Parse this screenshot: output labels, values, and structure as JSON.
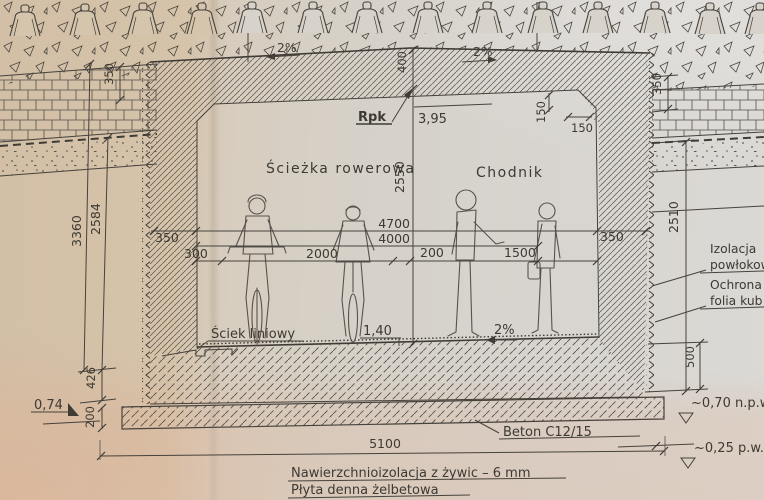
{
  "drawing": {
    "areas": {
      "bike_path": "Ścieżka rowerowa",
      "sidewalk": "Chodnik"
    },
    "annotations": {
      "benchmark": "Rpk",
      "benchmark_level": "3,95",
      "linear_drain": "Ściek liniowy",
      "drain_level": "1,40",
      "floor_slope": "2%",
      "ballast_slope_left": "2%",
      "ballast_slope_right": "2%",
      "foundation_concrete": "Beton C12/15",
      "surface_insulation": "Nawierzchnioizolacja z żywic – 6 mm",
      "bottom_slab": "Płyta denna żelbetowa",
      "wall_insulation_l1": "Izolacja",
      "wall_insulation_l2": "powłokow",
      "wall_protection_l1": "Ochrona",
      "wall_protection_l2": "folia kub",
      "datum_left": "0,74",
      "water_level_upper": "~0,70 n.p.w",
      "water_level_lower": "~0,25 p.w.g"
    },
    "dimensions": {
      "opening_width": "4700",
      "clear_width": "4000",
      "offset_left": "300",
      "bike_lane": "2000",
      "gap_mid": "200",
      "walkway": "1500",
      "wall_left": "350",
      "wall_right": "350",
      "ceiling_above": "400",
      "interior_height": "2550",
      "chamfer_v": "150",
      "chamfer_h": "150",
      "pavement_left": "350",
      "pavement_right": "350",
      "wall_depth_right": "2510",
      "foundation_drop": "500",
      "height_total_left": "3360",
      "height_inner_left": "2584",
      "base_left": "426",
      "foundation_thickness": "200",
      "foundation_width": "5100"
    },
    "colors": {
      "ink": "#3d3933",
      "paper_warm": "#d5c3aa",
      "paper_cool": "#d7d4cf"
    }
  }
}
